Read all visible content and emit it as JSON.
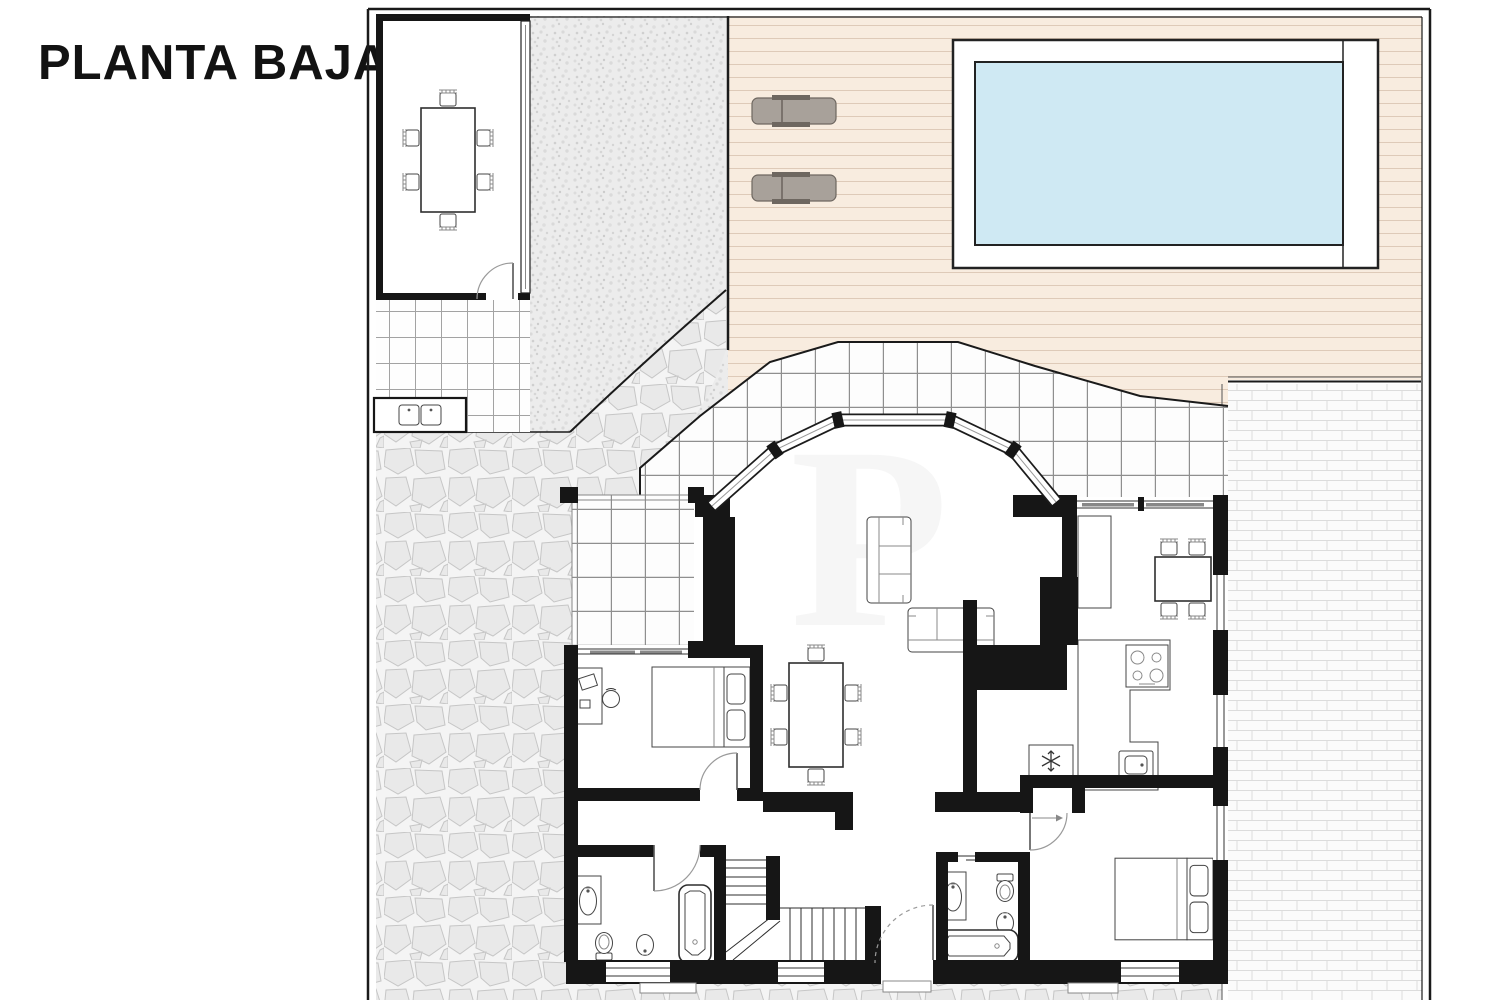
{
  "title": "PLANTA BAJA",
  "colors": {
    "wall": "#161616",
    "water": "#cfe9f3",
    "deck": "#f8ecdf",
    "deckline": "#decab8",
    "lounger": "#a8a19a",
    "loungerdark": "#6e6760",
    "paper": "#ffffff",
    "line": "#1a1a1a"
  },
  "plan": {
    "floor_label": "PLANTA BAJA",
    "outdoor_features": [
      "swimming pool with surround walkway",
      "wooden deck with 2 sun loungers",
      "detached summer-kitchen room with dining table and 6 chairs",
      "outdoor counter with double sink",
      "gravel yard",
      "crazy-paving stone path",
      "tiled porch around bay window",
      "tiled terrace",
      "brick-paved side patio"
    ],
    "rooms": [
      {
        "name": "living-dining room",
        "furniture": [
          "3-seat sofa",
          "3-seat sofa",
          "dining table with 6 chairs",
          "5-panel bay window"
        ]
      },
      {
        "name": "kitchen",
        "furniture": [
          "table with 4 chairs",
          "L-shaped counter",
          "4-burner hob",
          "sink",
          "fridge",
          "tall cabinet"
        ]
      },
      {
        "name": "bedroom 1",
        "furniture": [
          "double bed",
          "desk with chair"
        ]
      },
      {
        "name": "bathroom 1",
        "furniture": [
          "bathtub",
          "washbasin",
          "toilet",
          "bidet"
        ]
      },
      {
        "name": "bathroom 2",
        "furniture": [
          "bathtub",
          "washbasin",
          "toilet",
          "bidet"
        ]
      },
      {
        "name": "bedroom 2",
        "furniture": [
          "double bed"
        ]
      },
      {
        "name": "entrance hall",
        "furniture": [
          "entrance door"
        ]
      },
      {
        "name": "staircase",
        "furniture": [
          "U-shaped stair with landing"
        ]
      }
    ]
  }
}
